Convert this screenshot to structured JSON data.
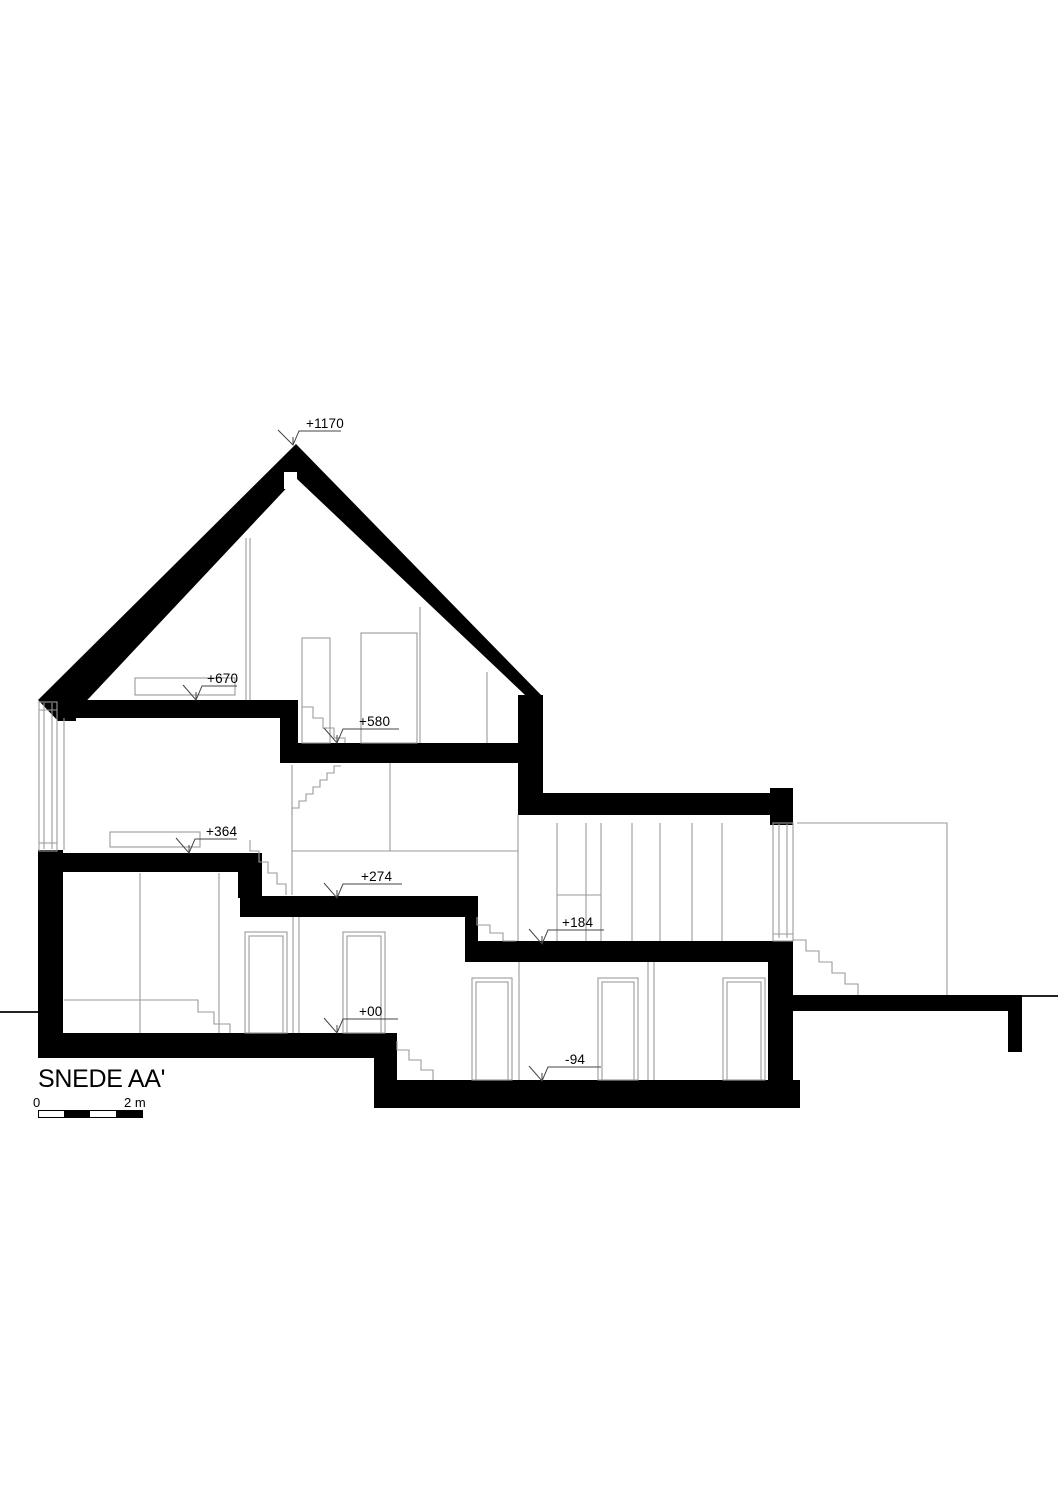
{
  "drawing": {
    "title": "SNEDE AA'",
    "levels": {
      "ridge": "+1170",
      "attic": "+670",
      "upper_rear": "+580",
      "upper_front": "+364",
      "mid": "+274",
      "ground_rear": "+184",
      "ground_front": "+00",
      "basement": "-94"
    },
    "scale_bar": {
      "start": "0",
      "end": "2 m"
    },
    "colors": {
      "ink": "#000000",
      "thin_line": "#9a9a9a",
      "annotation": "#444444",
      "background": "#ffffff"
    }
  }
}
